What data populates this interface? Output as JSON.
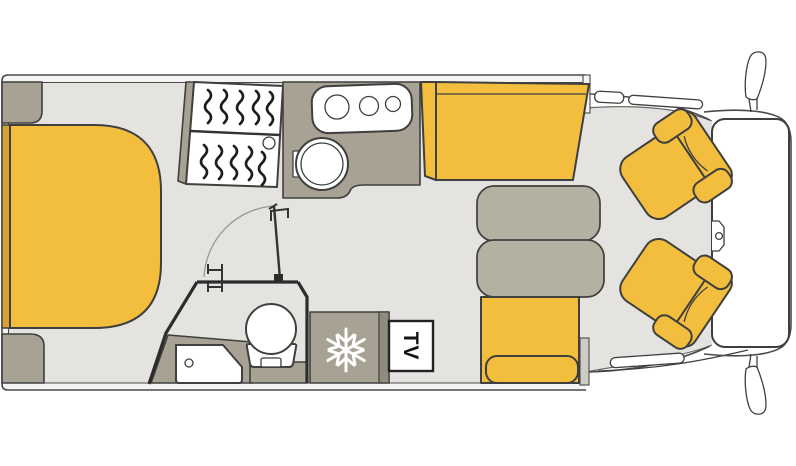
{
  "floorplan": {
    "kind": "motorhome top-view floor plan",
    "labels": {
      "tv": "TV"
    },
    "icons": [
      "snowflake-icon",
      "shower-squiggle-icon",
      "hob-burner-icon",
      "door-swing-arc-icon",
      "wing-mirror-icon"
    ],
    "features": [
      "rear island bed",
      "rear wardrobe cabinets",
      "shower cubicle",
      "kitchen hob with three burners",
      "kitchen sink",
      "bathroom washbasin",
      "toilet",
      "bathroom door with swing arc",
      "towel hooks",
      "fridge with freezer",
      "tv mount",
      "dinette table",
      "forward bench seat",
      "side bench seat",
      "swivelled driver seat",
      "swivelled passenger seat",
      "cab with windscreen and wing mirrors"
    ]
  },
  "colors": {
    "yellow": "#F3BE3D",
    "yellow_dark": "#D8A231",
    "taupe": "#A7A294",
    "taupe_light": "#B4B1A3",
    "taupe_dark": "#8F8B7F",
    "floor": "#E4E3E0",
    "wall_fill": "#F4F4F2",
    "wall_line": "#4A4A4A",
    "outline": "#3F3F3F",
    "bath_wall": "#2C2C2C"
  }
}
